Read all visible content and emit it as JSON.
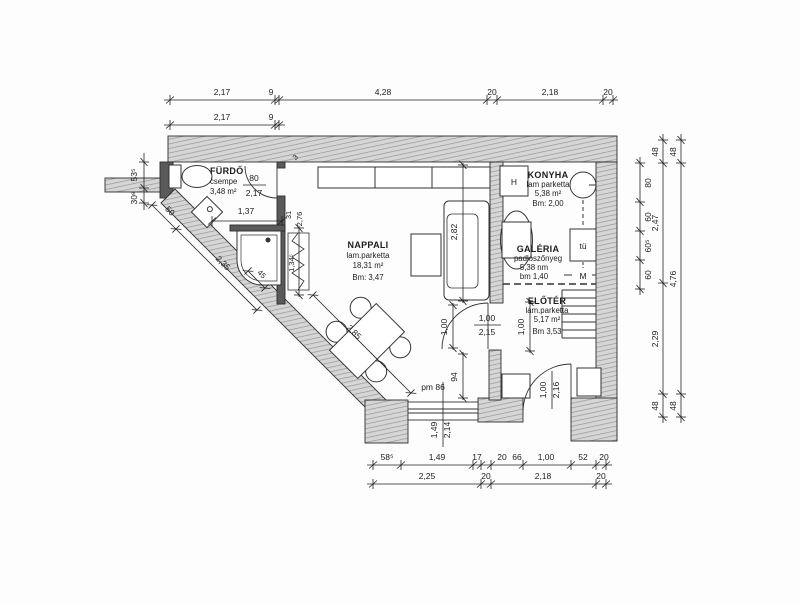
{
  "rooms": {
    "furdo": {
      "name": "FÜRDŐ",
      "finish": "csempe",
      "area": "3,48 m²"
    },
    "nappali": {
      "name": "NAPPALI",
      "finish": "lam.parketta",
      "area": "18,31 m²",
      "height": "Bm: 3,47"
    },
    "konyha": {
      "name": "KONYHA",
      "finish": "lam parketta",
      "area": "5,38 m²",
      "height": "Bm: 2,00"
    },
    "galeria": {
      "name": "GALÉRIA",
      "finish": "padlószőnyeg",
      "area": "5,38 nm",
      "height": "bm 1,40"
    },
    "eloter": {
      "name": "ELŐTÉR",
      "finish": "lam.parketta",
      "area": "5,17 m²",
      "height": "Bm 3,53"
    }
  },
  "openings": {
    "bathroom_door": {
      "w": "80",
      "h": "2,17"
    },
    "interior_door": {
      "w": "1,00",
      "h": "2,15"
    },
    "entrance_door": {
      "w": "1,00",
      "h": "2,16"
    },
    "window": {
      "w": "1,49",
      "h": "2,14"
    },
    "parapet": "pm 86"
  },
  "appliances": {
    "fridge": "H",
    "stove": "tü",
    "washer": "M"
  },
  "dims": {
    "top1": [
      "2,17",
      "9",
      "4,28",
      "20",
      "2,18",
      "20"
    ],
    "top2": [
      "2,17",
      "9"
    ],
    "bottom1": [
      "58⁵",
      "1,49",
      "17",
      "20",
      "66",
      "1,00",
      "52",
      "20"
    ],
    "bottom2": [
      "2,25",
      "20",
      "2,18",
      "20"
    ],
    "right_inner": [
      "80",
      "60",
      "60⁵",
      "60"
    ],
    "right_mid": [
      "48",
      "2,47",
      "2,29",
      "48"
    ],
    "right_outer": [
      "48",
      "4,76",
      "48"
    ],
    "left": [
      "53⁵",
      "30⁸"
    ],
    "diagonal": [
      "50",
      "2,35",
      "2,85",
      "45"
    ],
    "interior": {
      "bath_width": "1,37",
      "rad_width": "31",
      "wall_len": "2,76",
      "radiator_len": "1,34⁵",
      "sofa_wall": "2,82",
      "door_clear": "1,00",
      "pier": "94",
      "eloter": "1,00",
      "wall_thk": "3"
    }
  }
}
